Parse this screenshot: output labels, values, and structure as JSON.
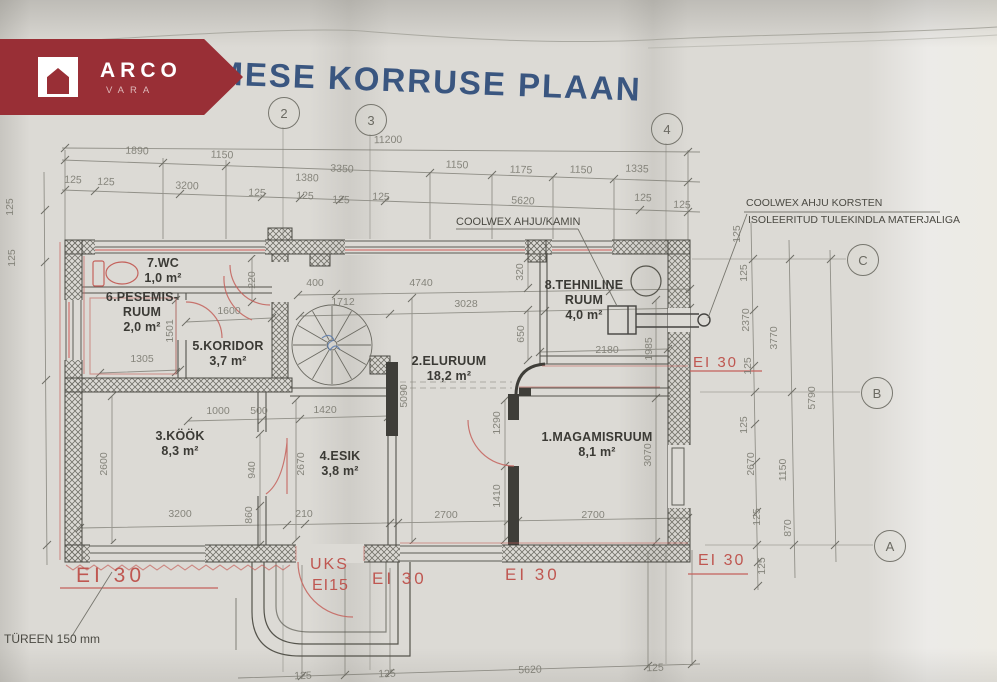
{
  "colors": {
    "paper": "#dcdad5",
    "ink": "#4b4a43",
    "dim_text": "#7e7d74",
    "red_marking": "#bf5751",
    "pink_window": "#d4827e",
    "title_blue": "#3a5680",
    "logo_maroon": "#992f36"
  },
  "logo": {
    "brand": "ARCO",
    "sub": "VARA"
  },
  "title": {
    "text": "IMESE KORRUSE PLAAN"
  },
  "grid": {
    "top": [
      {
        "label": "2",
        "x": 283,
        "y": 112
      },
      {
        "label": "3",
        "x": 370,
        "y": 119
      },
      {
        "label": "4",
        "x": 666,
        "y": 128
      }
    ],
    "right": [
      {
        "label": "C",
        "x": 862,
        "y": 259
      },
      {
        "label": "B",
        "x": 876,
        "y": 392
      },
      {
        "label": "A",
        "x": 889,
        "y": 545
      }
    ]
  },
  "rooms": [
    {
      "lines": [
        "7.WC",
        "1,0 m²"
      ],
      "x": 163,
      "y": 256
    },
    {
      "lines": [
        "6.PESEMIS-",
        "RUUM",
        "2,0 m²"
      ],
      "x": 142,
      "y": 290
    },
    {
      "lines": [
        "5.KORIDOR",
        "3,7 m²"
      ],
      "x": 228,
      "y": 339
    },
    {
      "lines": [
        "2.ELURUUM",
        "18,2 m²"
      ],
      "x": 449,
      "y": 354
    },
    {
      "lines": [
        "8.TEHNILINE",
        "RUUM",
        "4,0 m²"
      ],
      "x": 584,
      "y": 278
    },
    {
      "lines": [
        "3.KÖÖK",
        "8,3 m²"
      ],
      "x": 180,
      "y": 429
    },
    {
      "lines": [
        "4.ESIK",
        "3,8 m²"
      ],
      "x": 340,
      "y": 449
    },
    {
      "lines": [
        "1.MAGAMISRUUM",
        "8,1 m²"
      ],
      "x": 597,
      "y": 430
    }
  ],
  "annotations": [
    {
      "t": "COOLWEX AHJU/KAMIN",
      "x": 456,
      "y": 216,
      "c": "ink",
      "s": 11
    },
    {
      "t": "COOLWEX AHJU KORSTEN",
      "x": 746,
      "y": 197,
      "c": "ink",
      "s": 10.5
    },
    {
      "t": "ISOLEERITUD TULEKINDLA MATERJALIGA",
      "x": 748,
      "y": 214,
      "c": "ink",
      "s": 10.5
    },
    {
      "t": "EI 30",
      "x": 76,
      "y": 564,
      "c": "red",
      "s": 21,
      "ls": 4
    },
    {
      "t": "EI 30",
      "x": 372,
      "y": 569,
      "c": "red",
      "s": 17,
      "ls": 3
    },
    {
      "t": "EI 30",
      "x": 505,
      "y": 565,
      "c": "red",
      "s": 17,
      "ls": 3
    },
    {
      "t": "EI 30",
      "x": 698,
      "y": 552,
      "c": "red",
      "s": 16,
      "ls": 2
    },
    {
      "t": "EI 30",
      "x": 693,
      "y": 354,
      "c": "red",
      "s": 15,
      "ls": 2
    },
    {
      "t": "UKS",
      "x": 310,
      "y": 556,
      "c": "red",
      "s": 16,
      "ls": 2
    },
    {
      "t": "EI15",
      "x": 312,
      "y": 577,
      "c": "red",
      "s": 16,
      "ls": 1
    },
    {
      "t": "TÜREEN  150 mm",
      "x": 4,
      "y": 632,
      "c": "ink",
      "s": 12
    }
  ],
  "dims": [
    {
      "t": "11200",
      "x": 388,
      "y": 140,
      "r": -1
    },
    {
      "t": "1890",
      "x": 137,
      "y": 151,
      "r": 2
    },
    {
      "t": "1150",
      "x": 222,
      "y": 155,
      "r": 2
    },
    {
      "t": "3350",
      "x": 342,
      "y": 169,
      "r": 3
    },
    {
      "t": "1150",
      "x": 457,
      "y": 165,
      "r": 2
    },
    {
      "t": "1175",
      "x": 521,
      "y": 170,
      "r": 2
    },
    {
      "t": "1150",
      "x": 581,
      "y": 170,
      "r": 2
    },
    {
      "t": "1335",
      "x": 637,
      "y": 169,
      "r": 2
    },
    {
      "t": "1380",
      "x": 307,
      "y": 178,
      "r": 2
    },
    {
      "t": "125",
      "x": 73,
      "y": 180,
      "r": 2
    },
    {
      "t": "125",
      "x": 106,
      "y": 182,
      "r": 2
    },
    {
      "t": "3200",
      "x": 187,
      "y": 186,
      "r": 2
    },
    {
      "t": "125",
      "x": 257,
      "y": 193,
      "r": 2
    },
    {
      "t": "125",
      "x": 305,
      "y": 196,
      "r": 2
    },
    {
      "t": "125",
      "x": 341,
      "y": 200,
      "r": 2
    },
    {
      "t": "125",
      "x": 381,
      "y": 197,
      "r": 2
    },
    {
      "t": "5620",
      "x": 523,
      "y": 201,
      "r": 3
    },
    {
      "t": "125",
      "x": 643,
      "y": 198,
      "r": 2
    },
    {
      "t": "125",
      "x": 682,
      "y": 205,
      "r": 2
    },
    {
      "t": "125",
      "x": 10,
      "y": 207,
      "r": -90
    },
    {
      "t": "125",
      "x": 12,
      "y": 258,
      "r": -90
    },
    {
      "t": "220",
      "x": 252,
      "y": 280,
      "r": -90
    },
    {
      "t": "1600",
      "x": 229,
      "y": 311
    },
    {
      "t": "1501",
      "x": 170,
      "y": 331,
      "r": -90
    },
    {
      "t": "1305",
      "x": 142,
      "y": 359
    },
    {
      "t": "400",
      "x": 315,
      "y": 283
    },
    {
      "t": "4740",
      "x": 421,
      "y": 283
    },
    {
      "t": "1712",
      "x": 343,
      "y": 302
    },
    {
      "t": "3028",
      "x": 466,
      "y": 304
    },
    {
      "t": "320",
      "x": 520,
      "y": 272,
      "r": -90
    },
    {
      "t": "650",
      "x": 521,
      "y": 334,
      "r": -90
    },
    {
      "t": "5090",
      "x": 404,
      "y": 396,
      "r": -90
    },
    {
      "t": "2180",
      "x": 607,
      "y": 350
    },
    {
      "t": "1985",
      "x": 649,
      "y": 349,
      "r": -90
    },
    {
      "t": "1000",
      "x": 218,
      "y": 411
    },
    {
      "t": "500",
      "x": 259,
      "y": 411
    },
    {
      "t": "1420",
      "x": 325,
      "y": 410
    },
    {
      "t": "940",
      "x": 252,
      "y": 470,
      "r": -90
    },
    {
      "t": "2670",
      "x": 301,
      "y": 464,
      "r": -90
    },
    {
      "t": "860",
      "x": 249,
      "y": 515,
      "r": -90
    },
    {
      "t": "3200",
      "x": 180,
      "y": 514
    },
    {
      "t": "210",
      "x": 304,
      "y": 514
    },
    {
      "t": "2600",
      "x": 104,
      "y": 464,
      "r": -90
    },
    {
      "t": "1290",
      "x": 497,
      "y": 423,
      "r": -90
    },
    {
      "t": "1410",
      "x": 497,
      "y": 496,
      "r": -90
    },
    {
      "t": "2700",
      "x": 446,
      "y": 515
    },
    {
      "t": "2700",
      "x": 593,
      "y": 515
    },
    {
      "t": "3070",
      "x": 648,
      "y": 455,
      "r": -90
    },
    {
      "t": "125",
      "x": 737,
      "y": 234,
      "r": -90
    },
    {
      "t": "125",
      "x": 744,
      "y": 273,
      "r": -90
    },
    {
      "t": "2370",
      "x": 746,
      "y": 320,
      "r": -90
    },
    {
      "t": "125",
      "x": 748,
      "y": 366,
      "r": -90
    },
    {
      "t": "3770",
      "x": 774,
      "y": 338,
      "r": -90
    },
    {
      "t": "5790",
      "x": 812,
      "y": 398,
      "r": -90
    },
    {
      "t": "125",
      "x": 744,
      "y": 425,
      "r": -90
    },
    {
      "t": "2670",
      "x": 751,
      "y": 464,
      "r": -90
    },
    {
      "t": "1150",
      "x": 783,
      "y": 470,
      "r": -90
    },
    {
      "t": "125",
      "x": 757,
      "y": 517,
      "r": -90
    },
    {
      "t": "870",
      "x": 788,
      "y": 528,
      "r": -90
    },
    {
      "t": "125",
      "x": 762,
      "y": 566,
      "r": -90
    },
    {
      "t": "125",
      "x": 303,
      "y": 676,
      "r": -2
    },
    {
      "t": "125",
      "x": 387,
      "y": 674,
      "r": -2
    },
    {
      "t": "5620",
      "x": 530,
      "y": 670,
      "r": -2
    },
    {
      "t": "125",
      "x": 655,
      "y": 668,
      "r": -2
    }
  ]
}
